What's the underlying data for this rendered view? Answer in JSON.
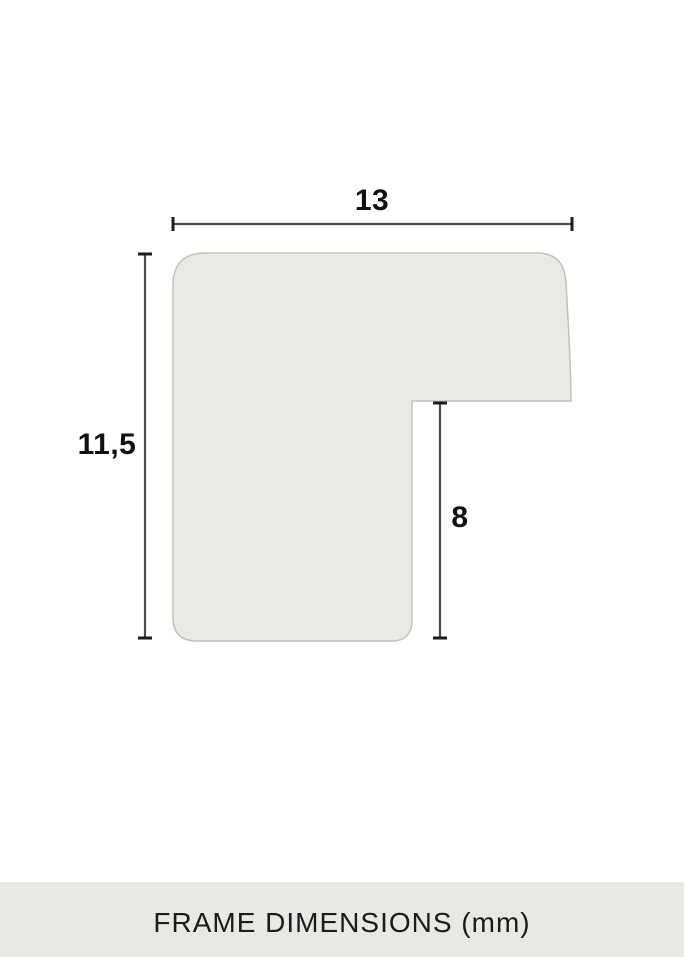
{
  "diagram": {
    "unit": "mm",
    "profile": {
      "fill": "#e9e9e5",
      "border_color": "#c2c2bd"
    },
    "dimension_line_color": "#4a4a4a",
    "label_color": "#111111",
    "dimensions": {
      "width": "13",
      "height": "11,5",
      "rabbet": "8"
    }
  },
  "footer": {
    "title": "FRAME DIMENSIONS (mm)",
    "background": "#e8e8e4",
    "text_color": "#1b1b1b"
  }
}
